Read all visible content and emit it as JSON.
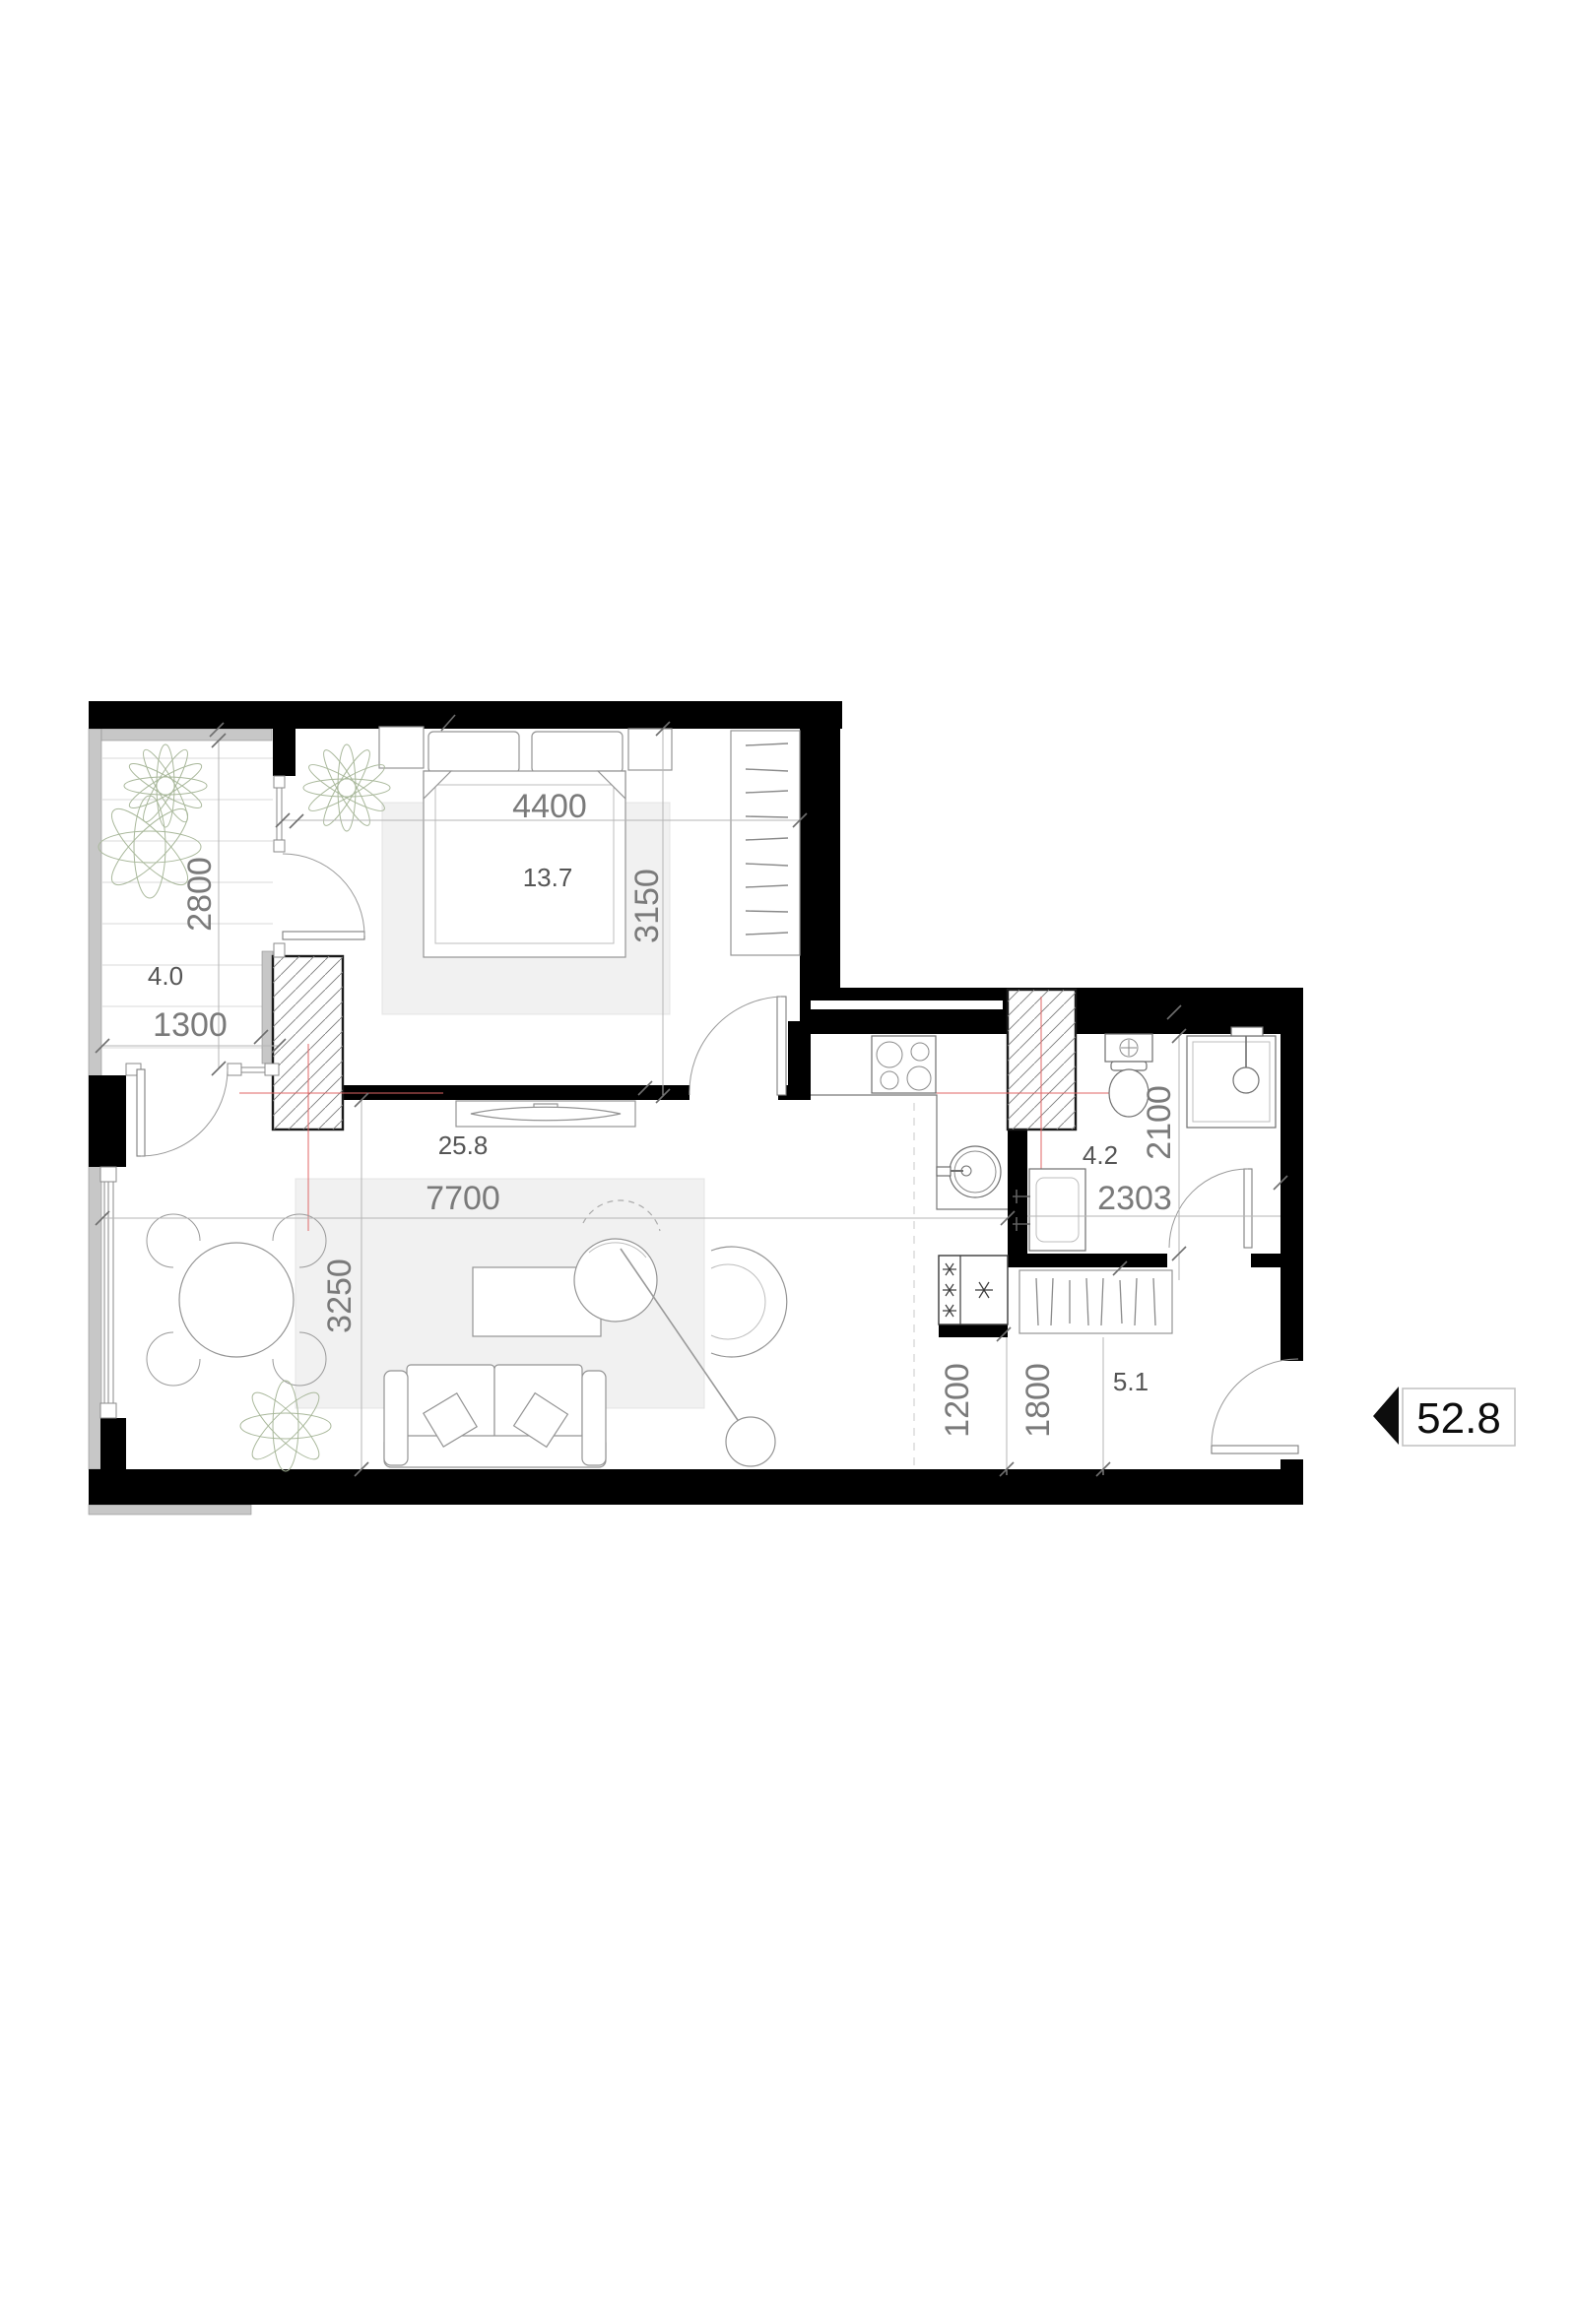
{
  "floor_plan": {
    "total_area": {
      "value": "52.8"
    },
    "rooms": {
      "balcony": {
        "area": "4.0",
        "dims": {
          "width": "1300",
          "depth": "2800"
        }
      },
      "bedroom": {
        "area": "13.7",
        "dims": {
          "width": "4400",
          "depth": "3150"
        }
      },
      "living_room": {
        "area": "25.8",
        "dims": {
          "width": "7700",
          "depth": "3250"
        }
      },
      "bathroom": {
        "area": "4.2",
        "dims": {
          "width": "2303",
          "depth": "2100"
        }
      },
      "hallway": {
        "area": "5.1",
        "dims": {
          "dim_a": "1200",
          "dim_b": "1800"
        }
      }
    },
    "colors": {
      "wall": "#000000",
      "parapet_gray": "#c7c7c7",
      "dimension_text": "#7a7a7a",
      "area_text": "#555555",
      "furniture_stroke": "#949494",
      "rug_fill": "#f1f1f1",
      "centerline_red": "#e06666",
      "plant_green": "#a9b89b",
      "total_text": "#0d0d0d"
    }
  }
}
